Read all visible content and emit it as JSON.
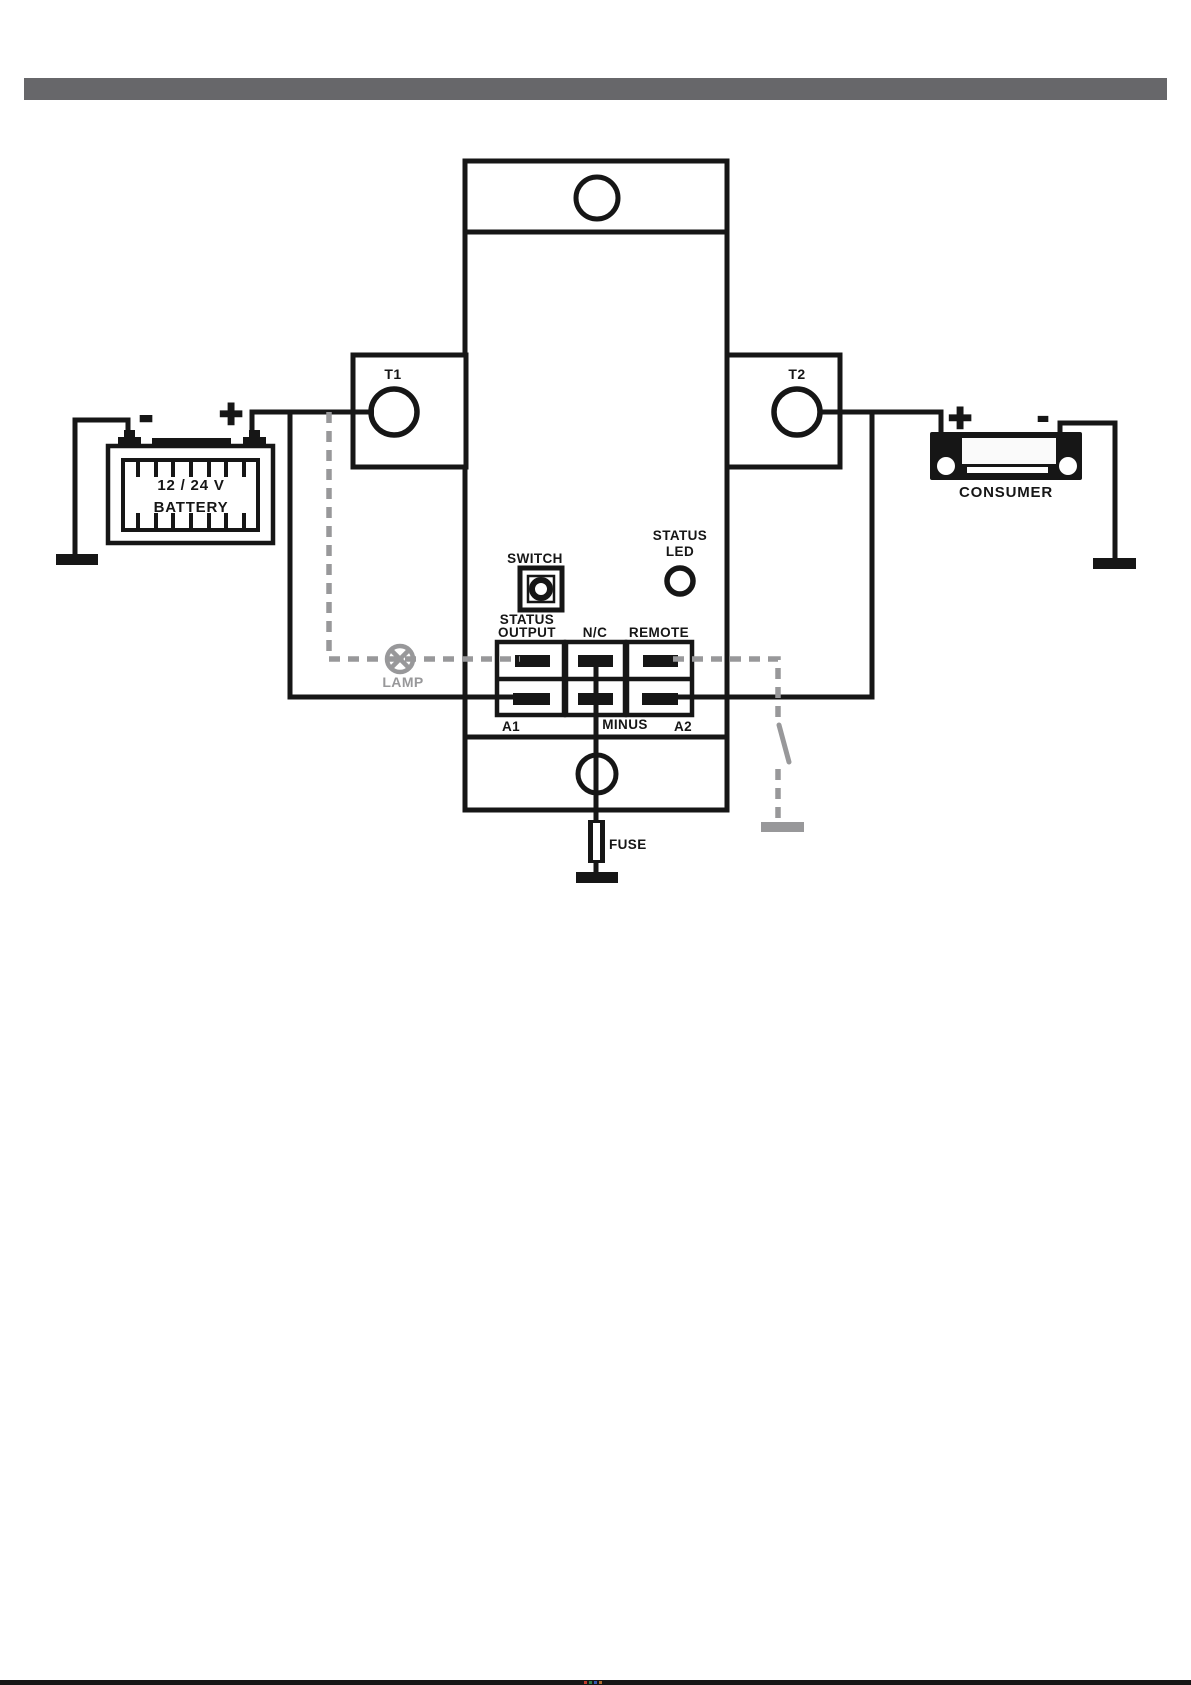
{
  "colors": {
    "ink": "#161616",
    "remote_circuit_gray": "#98989a",
    "divider_bar_gray": "#67676a",
    "paper": "#ffffff"
  },
  "device": {
    "t1": "T1",
    "t2": "T2",
    "switch_label": "SWITCH",
    "status_led": {
      "line1": "STATUS",
      "line2": "LED"
    },
    "terminals": {
      "status_output_line1": "STATUS",
      "status_output_line2": "OUTPUT",
      "nc": "N/C",
      "remote": "REMOTE",
      "a1": "A1",
      "minus": "MINUS",
      "a2": "A2"
    }
  },
  "battery": {
    "voltage": "12 / 24 V",
    "name": "BATTERY",
    "plus": "+",
    "minus": "-"
  },
  "consumer": {
    "name": "CONSUMER",
    "plus": "+",
    "minus": "-"
  },
  "lamp": {
    "label": "LAMP"
  },
  "fuse": {
    "label": "FUSE"
  }
}
